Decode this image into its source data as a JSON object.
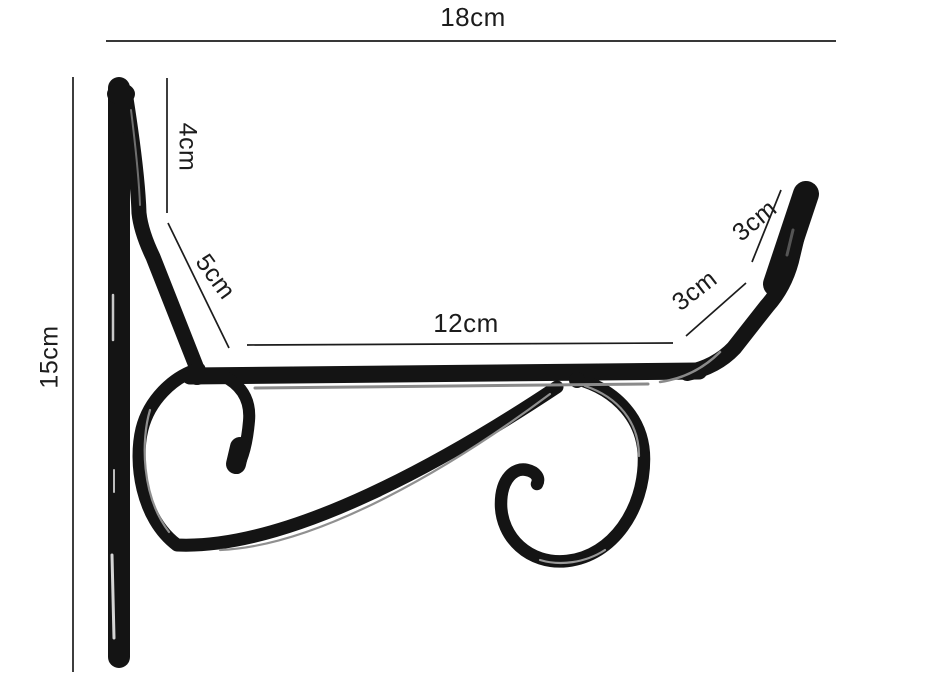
{
  "diagram": {
    "background_color": "#ffffff",
    "bracket_color": "#141414",
    "line_color": "#1c1c1c",
    "text_color": "#1c1c1c",
    "unit": "cm",
    "dimensions": {
      "overall_width": {
        "label": "18cm",
        "value": 18
      },
      "overall_height": {
        "label": "15cm",
        "value": 15
      },
      "top_tab_drop": {
        "label": "4cm",
        "value": 4
      },
      "diagonal_brace": {
        "label": "5cm",
        "value": 5
      },
      "arm_length": {
        "label": "12cm",
        "value": 12
      },
      "hook_rise": {
        "label": "3cm",
        "value": 3
      },
      "hook_tip": {
        "label": "3cm",
        "value": 3
      }
    }
  }
}
